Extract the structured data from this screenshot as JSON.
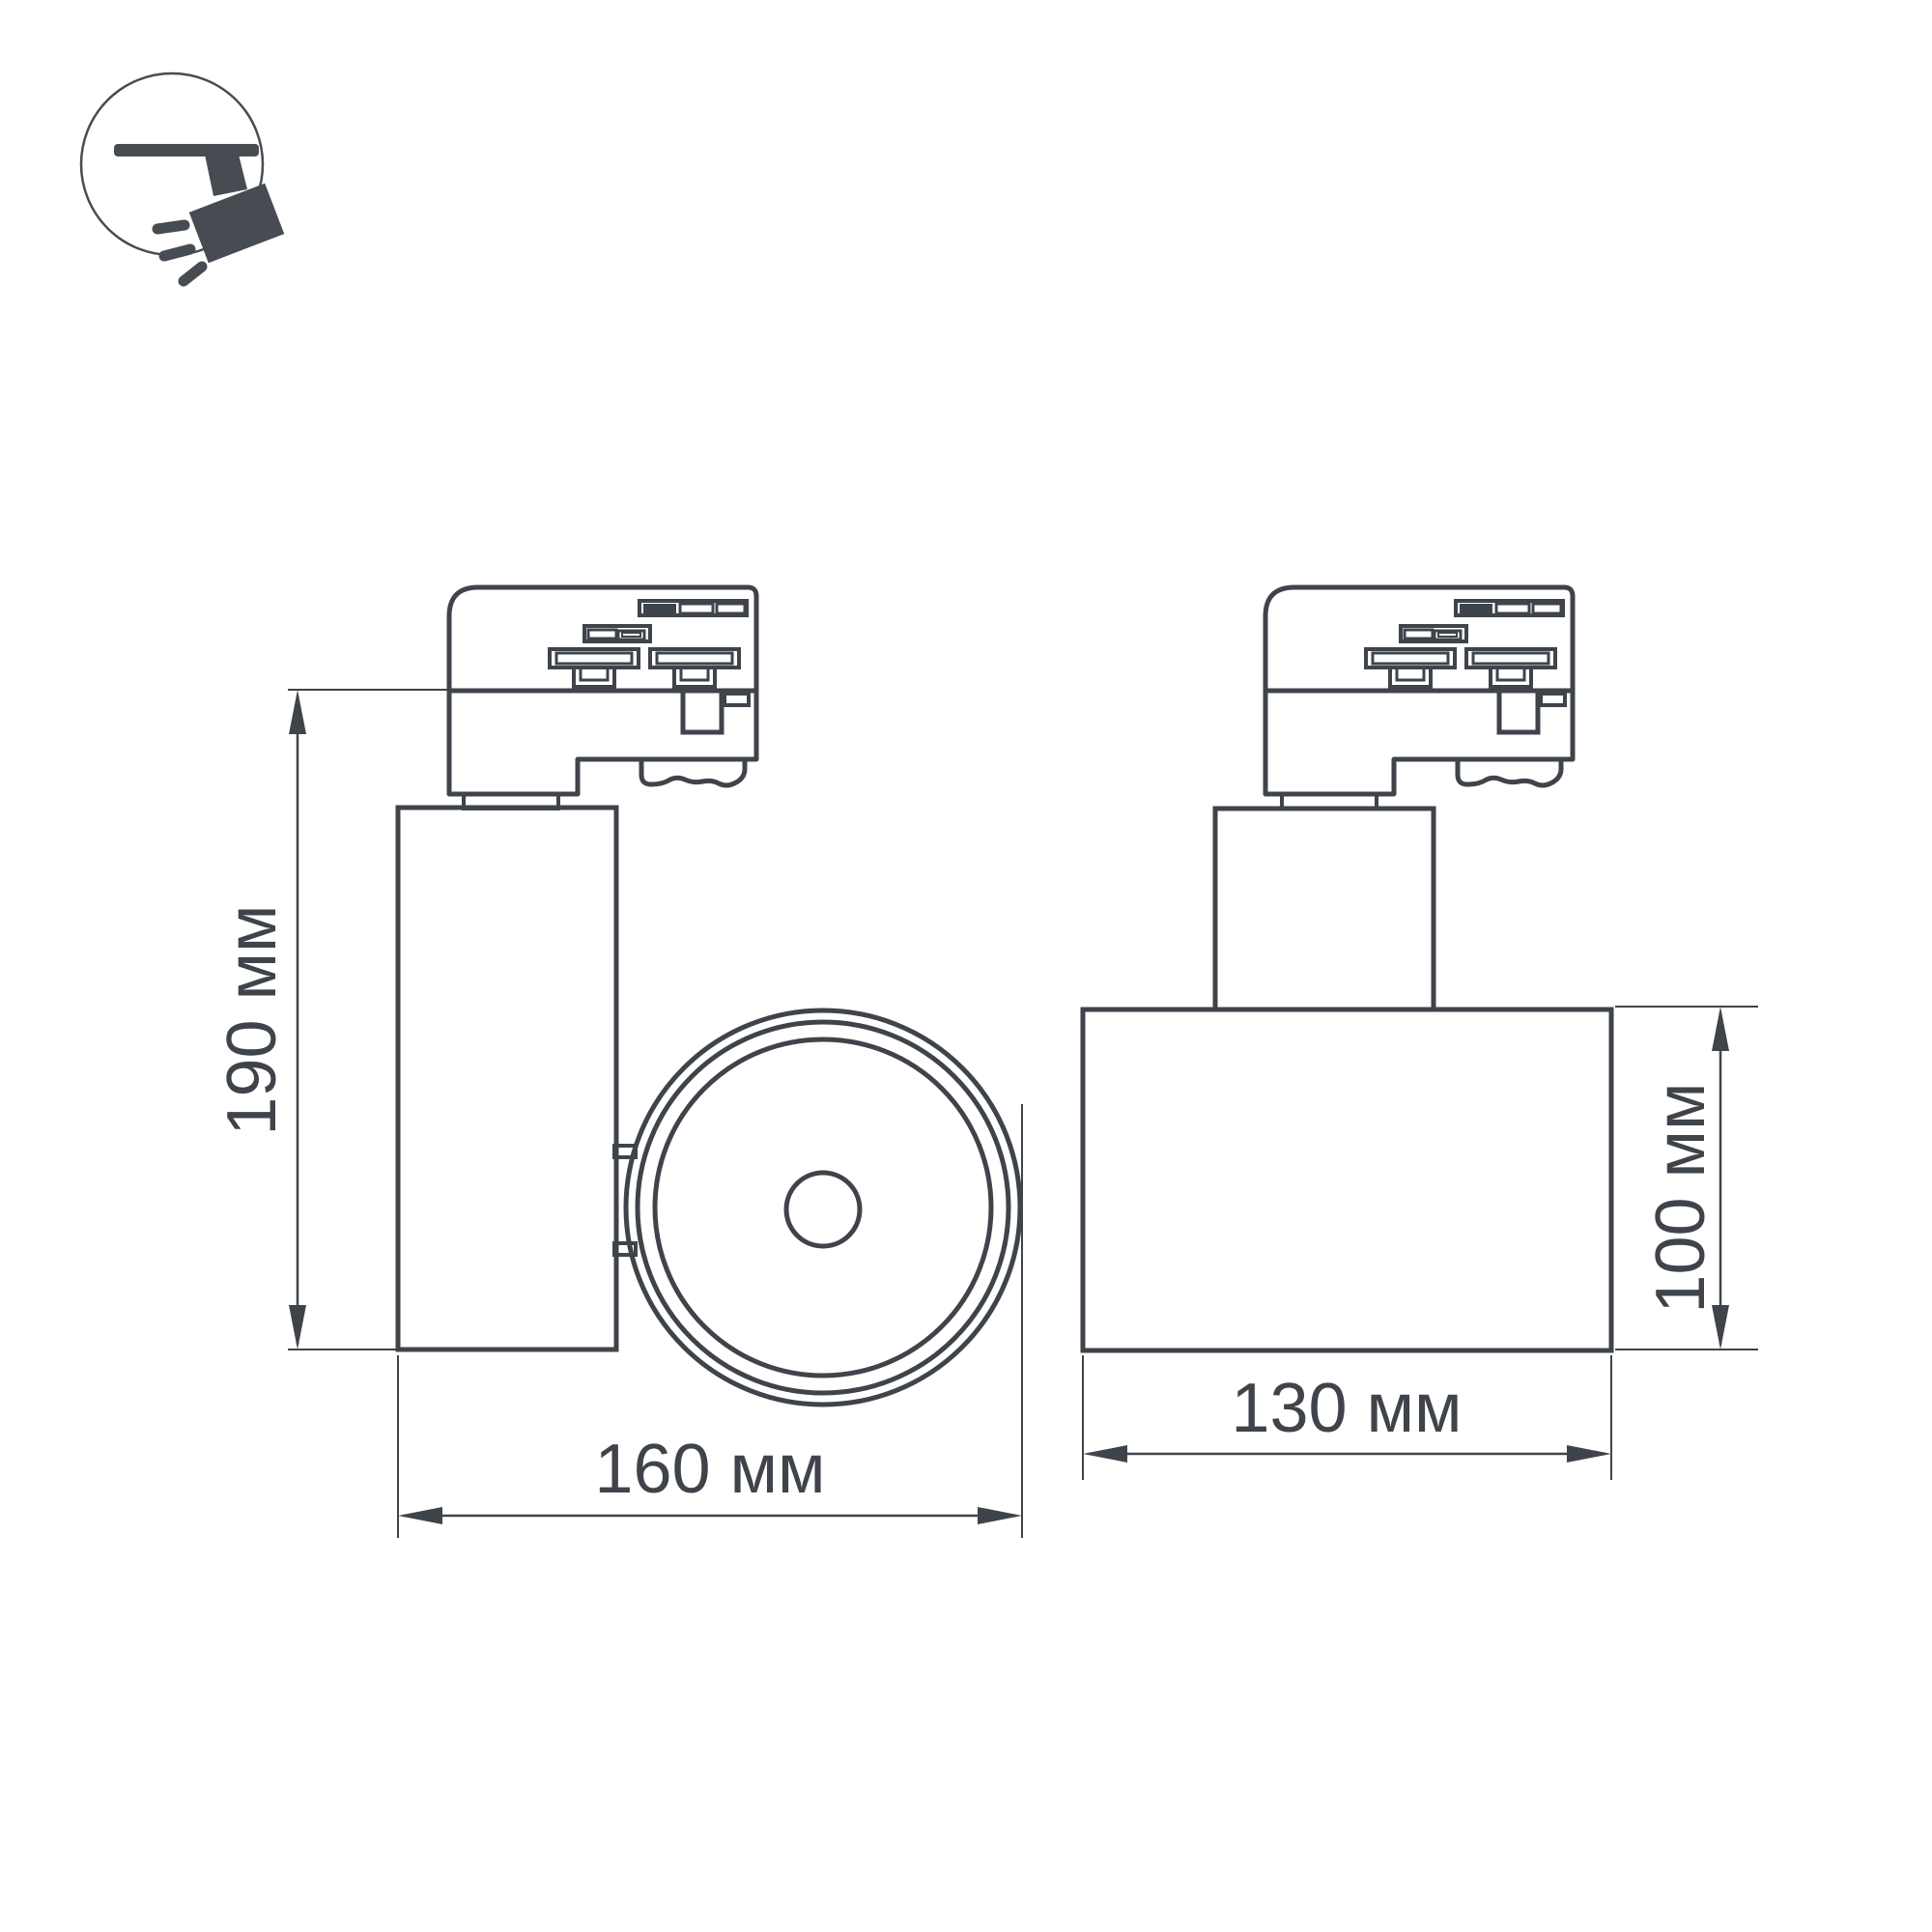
{
  "page": {
    "background": "#ffffff"
  },
  "drawing": {
    "type": "technical-dimension-drawing",
    "subject": "track-mounted spotlight, two projection views",
    "stroke_color": "#3f444a",
    "icon_color": "#474c52",
    "icon": {
      "name": "ceiling-track-spotlight-icon"
    },
    "labels": {
      "height": "190 мм",
      "depth": "160 мм",
      "width": "130 мм",
      "body_height": "100 мм"
    }
  }
}
